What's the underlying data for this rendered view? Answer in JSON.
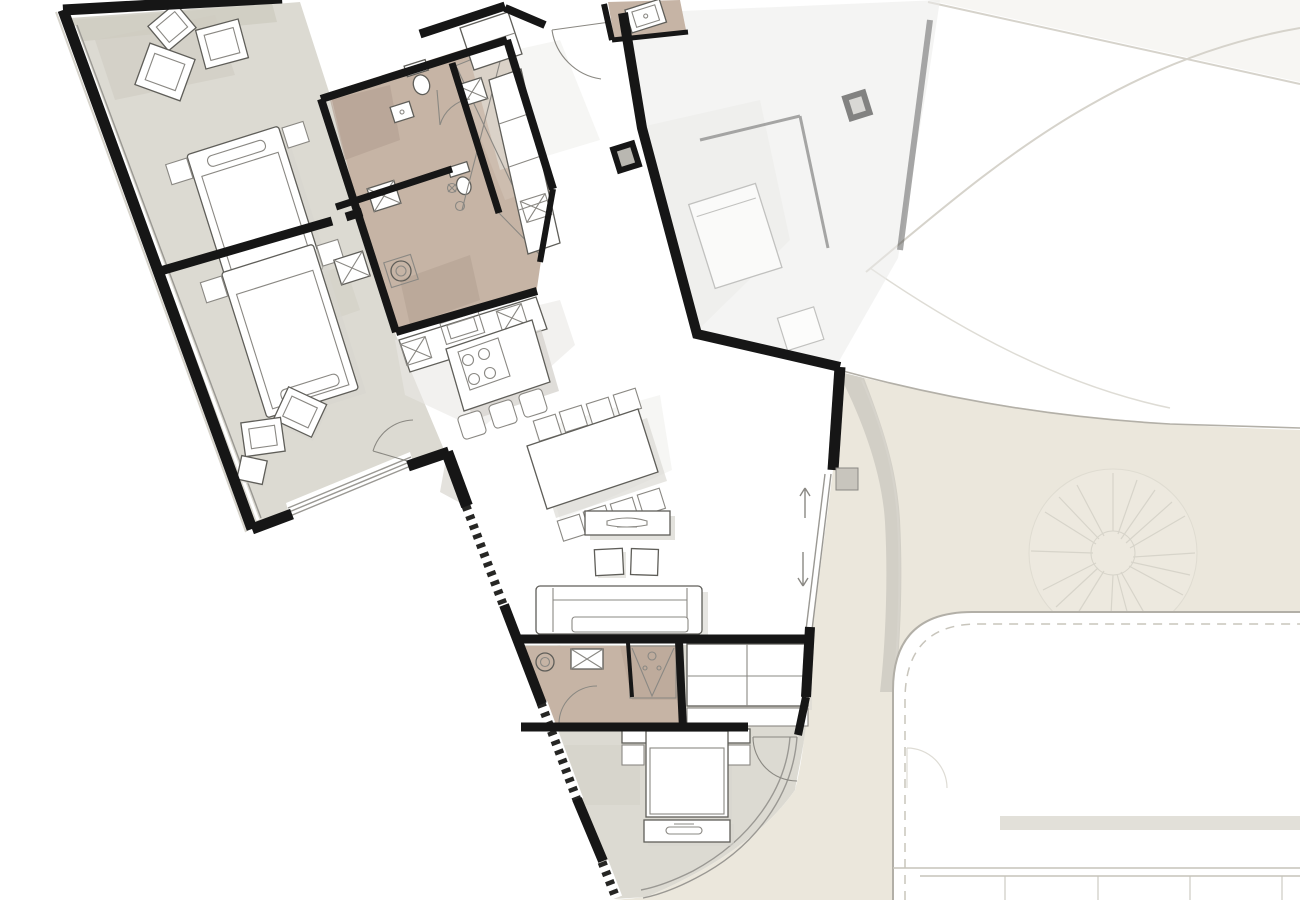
{
  "drawing": {
    "kind": "floor-plan",
    "view": "top-down plan drawing, no text labels visible"
  },
  "palette": {
    "background": "#ffffff",
    "walls": "#161616",
    "floor": "#dcdad2",
    "floor_dark": "#cfccc2",
    "bath": "#c6b4a5",
    "bath_dark": "#b3a092",
    "white": "#ffffff",
    "neighbor": "#ececea",
    "terrain": "#ebe7dc",
    "curb": "#cfccc3",
    "shadow": "#d7d5cf",
    "furniture_line": "#5f5e59",
    "furniture_soft": "#8a8883",
    "glass": "#9a9893",
    "faint": "#d6d3cb",
    "dotted": "#262624",
    "door_arc": "#8a8882",
    "driveway_edge": "#b2afa7",
    "tree_line": "#d4d1c7"
  },
  "legend": {
    "rooms": [
      "bedroom-upper",
      "bedroom-lower-left",
      "bathroom-main",
      "wc",
      "kitchen",
      "dining-area",
      "living-area",
      "bathroom-second",
      "closet",
      "bedroom-bottom",
      "entrance"
    ],
    "furniture_symbols": [
      "double-bed",
      "nightstand",
      "armchair",
      "kitchen-island-with-hob",
      "bar-stool",
      "dining-table",
      "dining-chair",
      "tv-sideboard",
      "pouf",
      "sofa",
      "wardrobe",
      "foot-bench"
    ],
    "fixture_symbols": [
      "toilet-symbol",
      "washbasin-symbol",
      "shower-symbol",
      "appliance-x-box",
      "sink-symbol"
    ],
    "outdoor_features": [
      "neighbor-unit",
      "terrace-table",
      "terrain",
      "curb-band",
      "tree-symbol",
      "driveway",
      "parking-lines",
      "path-curves"
    ],
    "annotations": [
      "door-swing-arc",
      "sliding-door-arrows",
      "window-band",
      "dotted-sill-band"
    ]
  }
}
